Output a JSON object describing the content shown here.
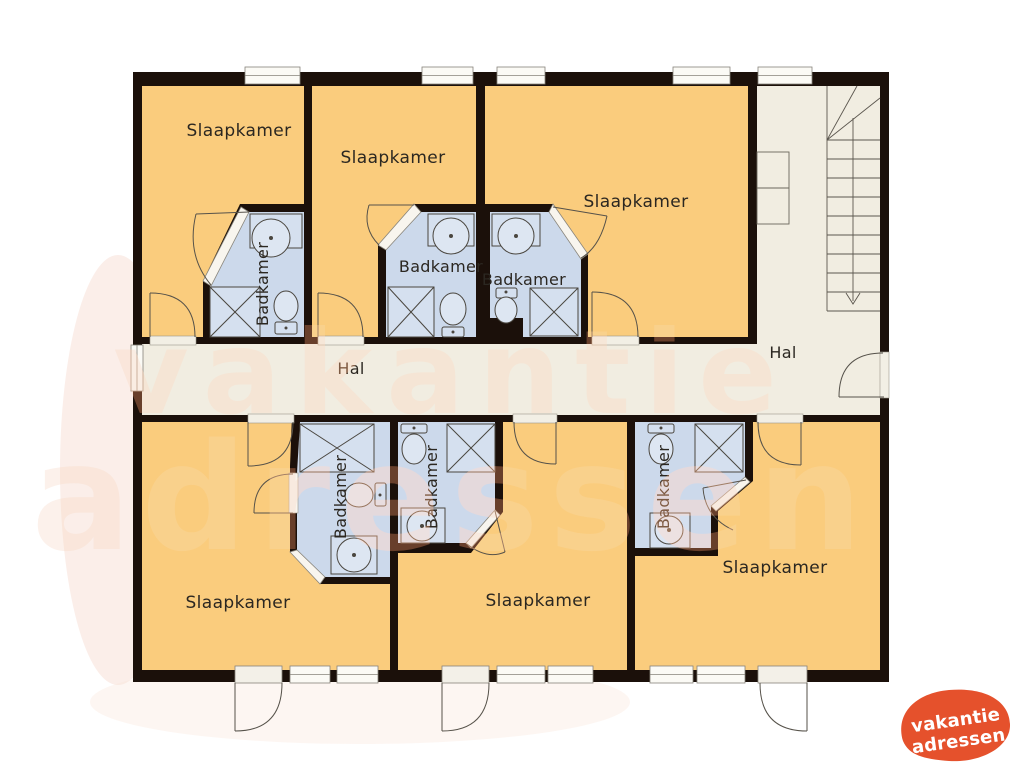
{
  "plan": {
    "bedrooms": [
      {
        "label": "Slaapkamer"
      },
      {
        "label": "Slaapkamer"
      },
      {
        "label": "Slaapkamer"
      },
      {
        "label": "Slaapkamer"
      },
      {
        "label": "Slaapkamer"
      },
      {
        "label": "Slaapkamer"
      }
    ],
    "bathrooms": [
      {
        "label": "Badkamer"
      },
      {
        "label": "Badkamer"
      },
      {
        "label": "Badkamer"
      },
      {
        "label": "Badkamer"
      },
      {
        "label": "Badkamer"
      },
      {
        "label": "Badkamer"
      }
    ],
    "halls": [
      {
        "label": "Hal"
      },
      {
        "label": "Hal"
      }
    ]
  },
  "watermark": {
    "line1": "vakantie",
    "line2": "adressen"
  },
  "logo": {
    "line1": "vakantie",
    "line2": "adressen"
  },
  "colors": {
    "bedroom": "#facc7d",
    "bathroom": "#ccd9eb",
    "hall": "#f1ede1",
    "wall": "#1b100a",
    "threshold": "#f2efe5",
    "window": "#fbfaf5",
    "logo_orange": "#e5512c",
    "watermark_pink": "#edba9c"
  }
}
